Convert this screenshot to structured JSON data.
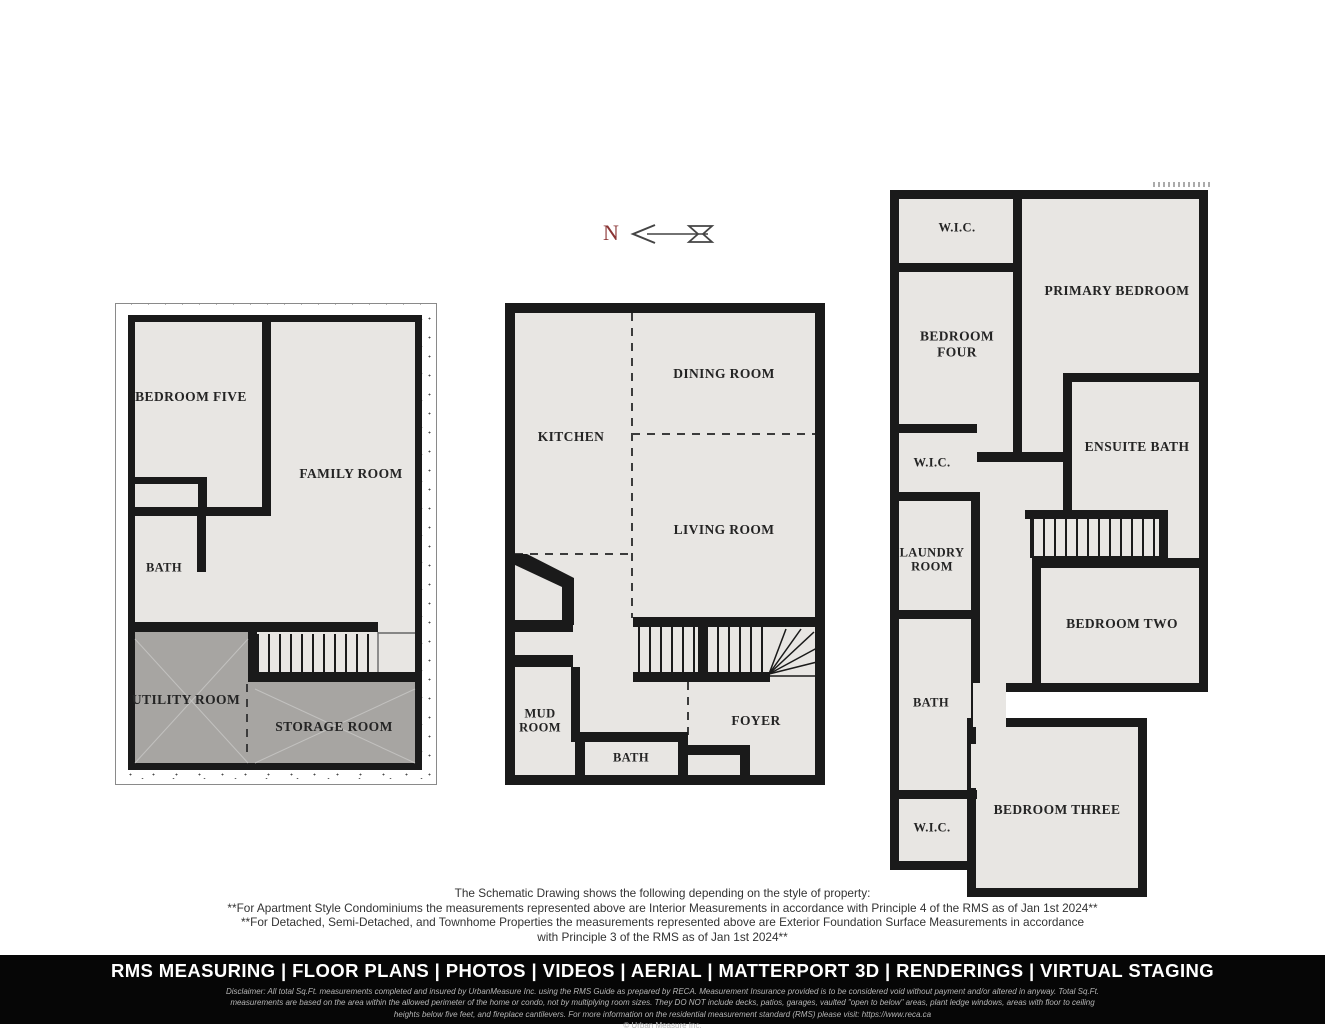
{
  "north_indicator": {
    "label": "N"
  },
  "plans": {
    "basement": {
      "rooms": {
        "bedroom_five": "BEDROOM FIVE",
        "family_room": "FAMILY ROOM",
        "bath": "BATH",
        "utility_room": "UTILITY ROOM",
        "storage_room": "STORAGE ROOM"
      }
    },
    "main": {
      "rooms": {
        "kitchen": "KITCHEN",
        "dining_room": "DINING ROOM",
        "living_room": "LIVING ROOM",
        "mud_room": "MUD ROOM",
        "bath": "BATH",
        "foyer": "FOYER"
      }
    },
    "upper": {
      "rooms": {
        "wic_top": "W.I.C.",
        "primary_bedroom": "PRIMARY BEDROOM",
        "bedroom_four": "BEDROOM FOUR",
        "ensuite_bath": "ENSUITE BATH",
        "wic_mid": "W.I.C.",
        "laundry_room": "LAUNDRY ROOM",
        "bath": "BATH",
        "bedroom_two": "BEDROOM TWO",
        "wic_bottom": "W.I.C.",
        "bedroom_three": "BEDROOM THREE"
      }
    }
  },
  "disclaimer": {
    "lines": [
      "The Schematic Drawing shows the following depending on the style of property:",
      "**For Apartment Style Condominiums the measurements represented above are Interior Measurements in accordance with Principle 4 of the RMS as of Jan 1st 2024**",
      "**For Detached, Semi-Detached, and Townhome Properties the measurements represented above are Exterior Foundation Surface Measurements in accordance",
      "with Principle  3 of the RMS as of Jan 1st 2024**"
    ]
  },
  "footer": {
    "services": "RMS MEASURING | FLOOR PLANS | PHOTOS | VIDEOS | AERIAL | MATTERPORT 3D | RENDERINGS | VIRTUAL STAGING",
    "fine_print": [
      "Disclaimer: All total Sq.Ft. measurements completed and insured by UrbanMeasure Inc. using the RMS Guide as prepared by RECA. Measurement Insurance provided is to be considered void without payment and/or altered in anyway. Total Sq.Ft.",
      "measurements are based on the area within the allowed perimeter of the home or condo, not by multiplying room sizes. They DO NOT include decks, patios, garages, vaulted \"open to below\" areas, plant ledge windows, areas with floor to ceiling",
      "heights below five feet, and fireplace cantilevers. For more information on the residential measurement standard (RMS) please visit: https://www.reca.ca"
    ],
    "copyright": "© Urban Measure Inc."
  },
  "colors": {
    "wall": "#1a1a1a",
    "floor_fill": "#e8e6e3",
    "dark_room_fill": "#a7a5a2",
    "north_letter": "#8a3434",
    "footer_background": "#060606"
  }
}
